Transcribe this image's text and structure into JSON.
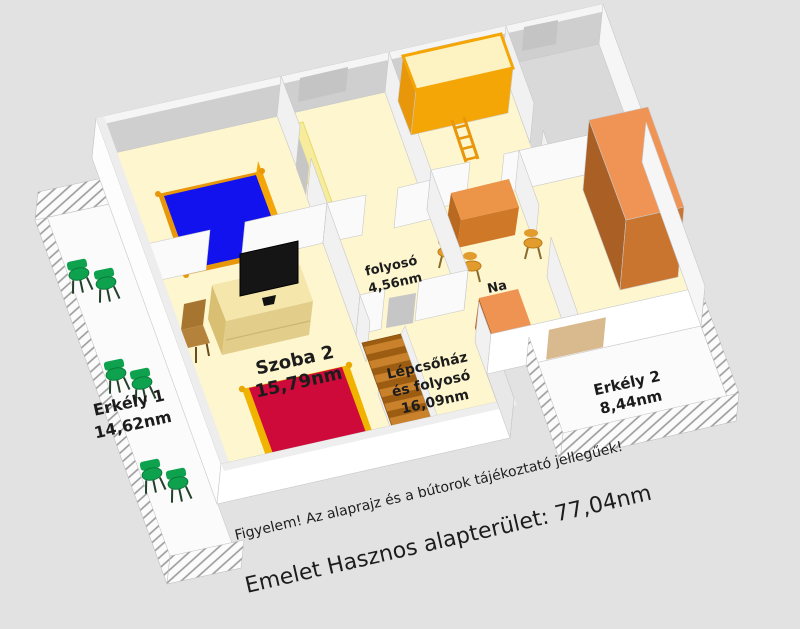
{
  "plan": {
    "note": "Figyelem! Az alaprajz és a bútorok tájékoztató jellegűek!",
    "summary": "Emelet Hasznos alapterület: 77,04nm",
    "rooms": {
      "szoba2": {
        "name": "Szoba 2",
        "area": "15,79nm"
      },
      "erkely1": {
        "name": "Erkély 1",
        "area": "14,62nm"
      },
      "erkely2": {
        "name": "Erkély 2",
        "area": "8,44nm"
      },
      "folyoso": {
        "name": "folyosó",
        "area": "4,56nm"
      },
      "lepcsohaz": {
        "line1": "Lépcsőház",
        "line2": "és folyosó",
        "area": "16,09nm"
      },
      "nappali": {
        "name": "Na"
      }
    }
  },
  "colors": {
    "background": "#e2e2e2",
    "floor": "#fdf6cf",
    "balcony_floor": "#fbfbfb",
    "wall_white": "#ffffff",
    "wall_light": "#f1f1f1",
    "wall_gray": "#cfcfcf",
    "wall_top": "#f5f5f5",
    "mattress_blue": "#1212ee",
    "bed_red": "#ce0a3a",
    "frame_gold": "#f0b400",
    "furniture_orange": "#f5a607",
    "orange_deep": "#e8960a",
    "wood_light": "#f5e6ac",
    "wood_mid": "#e3cd8a",
    "wood_dark": "#d8bf72",
    "chair_brown": "#b5823c",
    "wardrobe_front": "#c9742f",
    "wardrobe_side": "#aa5f24",
    "wardrobe_top": "#f09455",
    "chair_green": "#0ea24e",
    "stair": "#c9812b",
    "stair_dark": "#9c5d12",
    "glass_gray": "#c4c4c4",
    "door_tan": "#d9b98e",
    "tv_black": "#151515",
    "text": "#1c1c1c"
  }
}
